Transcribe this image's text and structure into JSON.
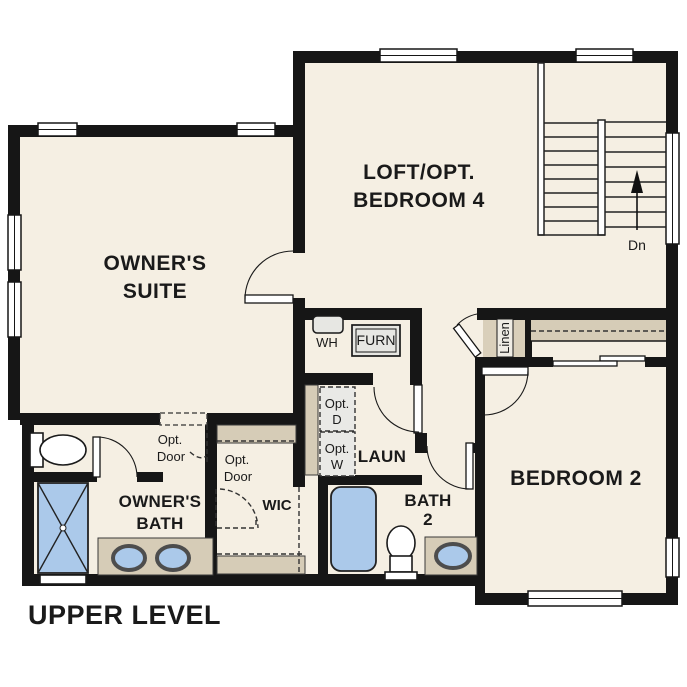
{
  "title": "UPPER LEVEL",
  "rooms": {
    "owners_suite": {
      "line1": "OWNER'S",
      "line2": "SUITE"
    },
    "loft": {
      "line1": "LOFT/OPT.",
      "line2": "BEDROOM 4"
    },
    "bedroom_2": {
      "label": "BEDROOM 2"
    },
    "owners_bath": {
      "line1": "OWNER'S",
      "line2": "BATH"
    },
    "bath_2": {
      "line1": "BATH",
      "line2": "2"
    },
    "laundry": {
      "label": "LAUN"
    },
    "wic": {
      "label": "WIC"
    },
    "linen": {
      "label": "Linen"
    }
  },
  "labels": {
    "water_heater": "WH",
    "furnace": "FURN",
    "opt_dryer": {
      "line1": "Opt.",
      "line2": "D"
    },
    "opt_washer": {
      "line1": "Opt.",
      "line2": "W"
    },
    "opt_door": {
      "line1": "Opt.",
      "line2": "Door"
    },
    "stair_direction": "Dn"
  },
  "colors": {
    "floor": "#f5efe3",
    "wall": "#161616",
    "fixture_blue": "#abc9ea",
    "counter_tan": "#d6ccb7",
    "appliance_gray": "#e7e7e3"
  }
}
